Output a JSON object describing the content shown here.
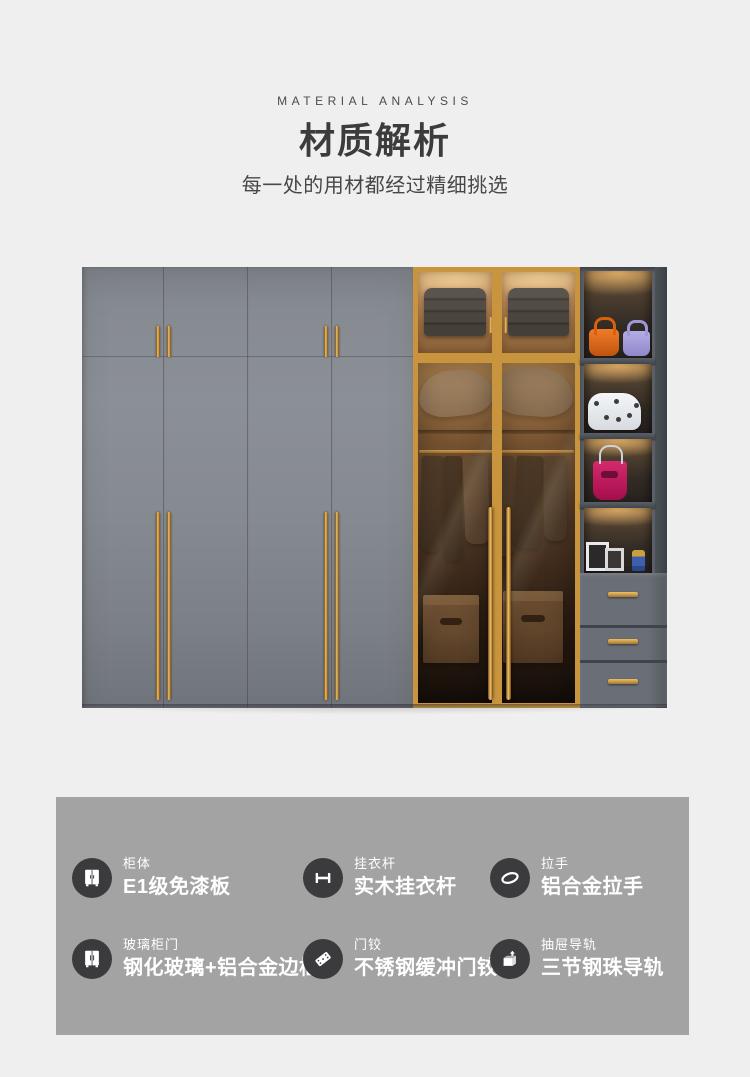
{
  "header": {
    "eyebrow": "MATERIAL ANALYSIS",
    "title": "材质解析",
    "subtitle": "每一处的用材都经过精细挑选"
  },
  "product_image": {
    "description": "六门衣柜实拍图：灰色免漆板柜门配金色拉手，中部钢化玻璃金色边框柜门内挂衣区，右侧开放格置物架带灯带、手提包与相框，下方三个抽屉",
    "accent_gold": "#CF9B45",
    "door_gray": "#878B91",
    "shelf_dark": "#5B6068",
    "bag_colors": [
      "#F07C28",
      "#B4ADE6",
      "#F4F6F8",
      "#D42A6E"
    ]
  },
  "features": {
    "panel_bg": "#A3A3A3",
    "icon_circle_bg": "#3B3B3D",
    "items": [
      {
        "icon": "wardrobe-icon",
        "label": "柜体",
        "value": "E1级免漆板"
      },
      {
        "icon": "hanging-rod-icon",
        "label": "挂衣杆",
        "value": "实木挂衣杆"
      },
      {
        "icon": "pull-handle-icon",
        "label": "拉手",
        "value": "铝合金拉手"
      },
      {
        "icon": "glass-door-icon",
        "label": "玻璃柜门",
        "value": "钢化玻璃+铝合金边框"
      },
      {
        "icon": "hinge-icon",
        "label": "门铰",
        "value": "不锈钢缓冲门铰"
      },
      {
        "icon": "drawer-slide-icon",
        "label": "抽屉导轨",
        "value": "三节钢珠导轨"
      }
    ]
  },
  "colors": {
    "page_bg": "#EFEFEF",
    "title_text": "#3C3C3C",
    "subtitle_text": "#474747",
    "feature_text": "#FFFFFF"
  }
}
